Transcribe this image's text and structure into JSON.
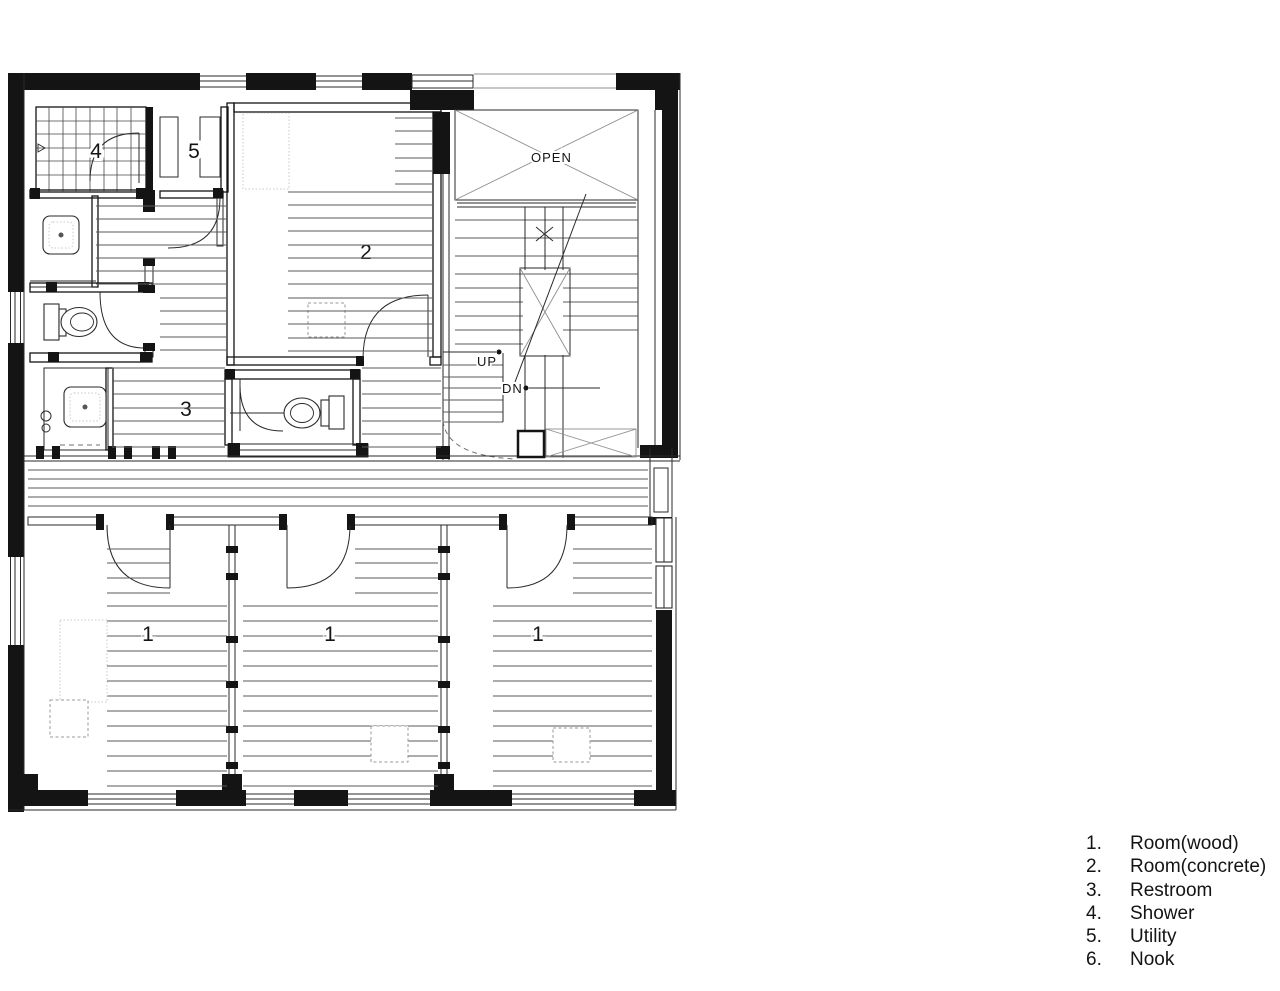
{
  "plan": {
    "labels": {
      "room1": "1",
      "room2": "2",
      "room3": "3",
      "room4": "4",
      "room5": "5"
    },
    "annotations": {
      "open": "OPEN",
      "up": "UP",
      "dn": "DN"
    },
    "colors": {
      "line": "#141414",
      "light_line": "#8f8f8f",
      "background": "#ffffff"
    }
  },
  "legend": {
    "items": [
      {
        "num": "1.",
        "label": "Room(wood)"
      },
      {
        "num": "2.",
        "label": "Room(concrete)"
      },
      {
        "num": "3.",
        "label": "Restroom"
      },
      {
        "num": "4.",
        "label": "Shower"
      },
      {
        "num": "5.",
        "label": "Utility"
      },
      {
        "num": "6.",
        "label": "Nook"
      }
    ]
  }
}
